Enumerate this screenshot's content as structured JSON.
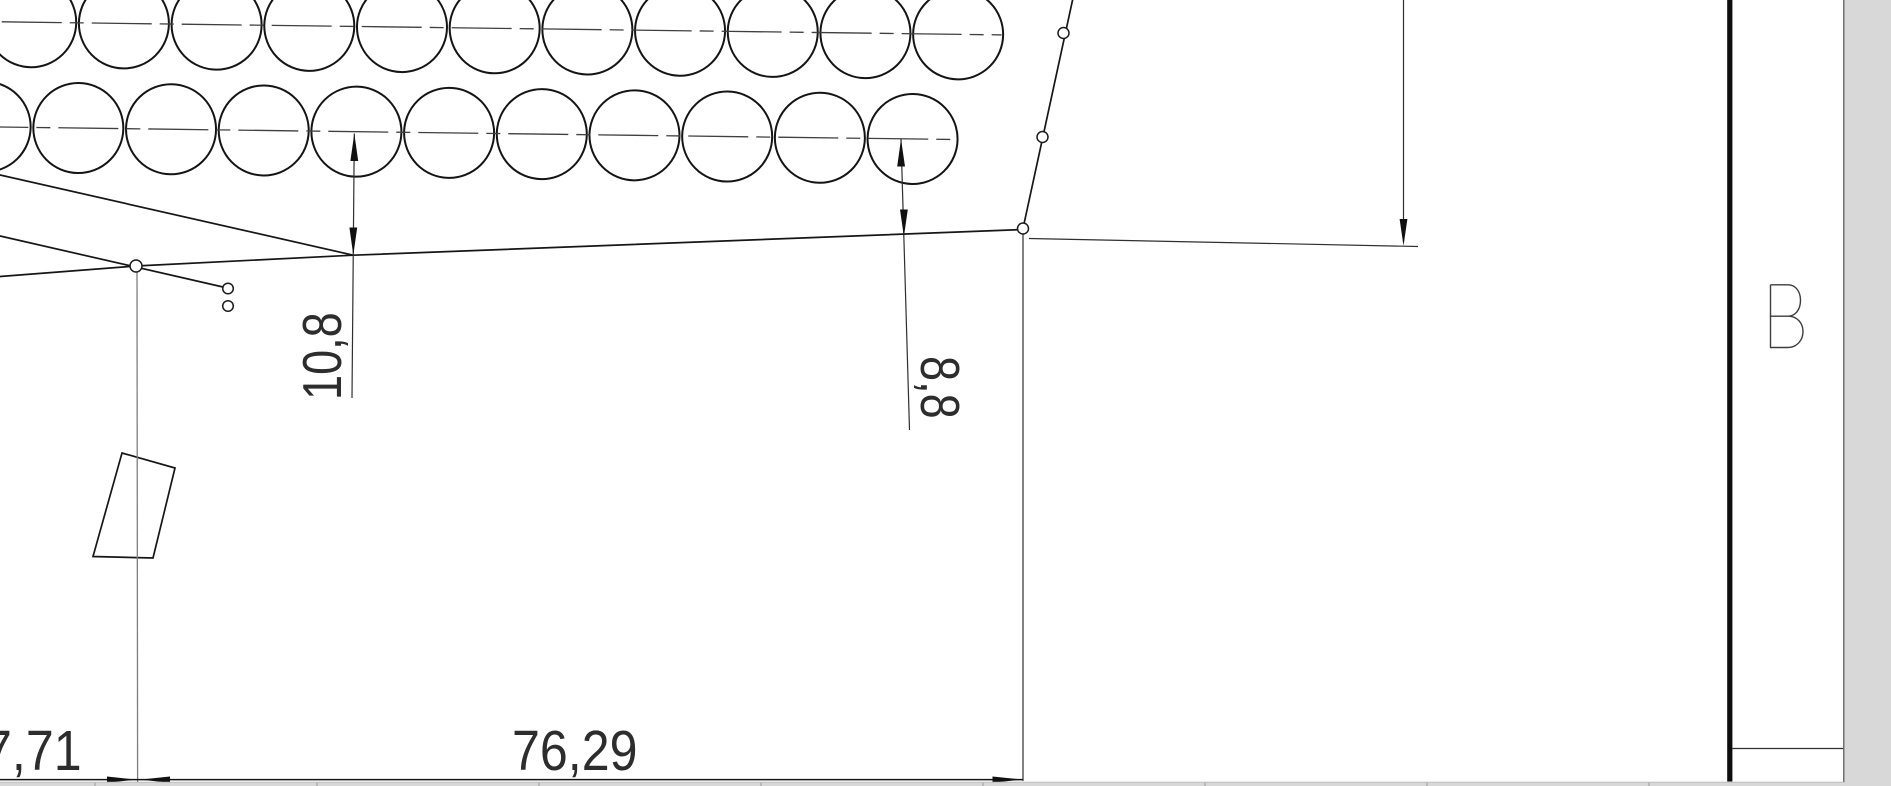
{
  "canvas": {
    "width": 1891,
    "height": 786,
    "page_background": "#ffffff",
    "outside_background": "#d8d8d8",
    "line_color": "#1a1a1a"
  },
  "drawing": {
    "dimensions": {
      "left_horizontal": "7,71",
      "main_horizontal": "76,29",
      "left_vertical": "10,8",
      "right_vertical": "8,8"
    },
    "zone_label": "B",
    "tilt_deg": 0.75,
    "circle_rows": [
      {
        "name": "row-1",
        "cy": 21.8,
        "r": 45,
        "centers": [
          31.5,
          124.2,
          216.9,
          309.6,
          402.3,
          495.0,
          587.7,
          680.4,
          773.1,
          865.8,
          958.5
        ]
      },
      {
        "name": "row-2",
        "cy": 127.0,
        "r": 45,
        "centers": [
          -12.7,
          80.0,
          172.7,
          265.4,
          358.1,
          450.8,
          543.5,
          636.2,
          728.9,
          821.6,
          914.3
        ]
      }
    ],
    "node_circles": [
      {
        "cx": 1063.5,
        "cy": 33.0,
        "r": 5.5
      },
      {
        "cx": 1042.5,
        "cy": 137.0,
        "r": 5.5
      },
      {
        "cx": 1023.0,
        "cy": 228.5,
        "r": 5.5
      },
      {
        "cx": 136.0,
        "cy": 266.0,
        "r": 6.0
      },
      {
        "cx": 228.0,
        "cy": 288.5,
        "r": 5.3
      },
      {
        "cx": 228.0,
        "cy": 306.0,
        "r": 5.3
      }
    ],
    "bottom_strip_ticks": [
      95,
      317,
      539,
      761,
      983,
      1205,
      1427,
      1649
    ]
  }
}
